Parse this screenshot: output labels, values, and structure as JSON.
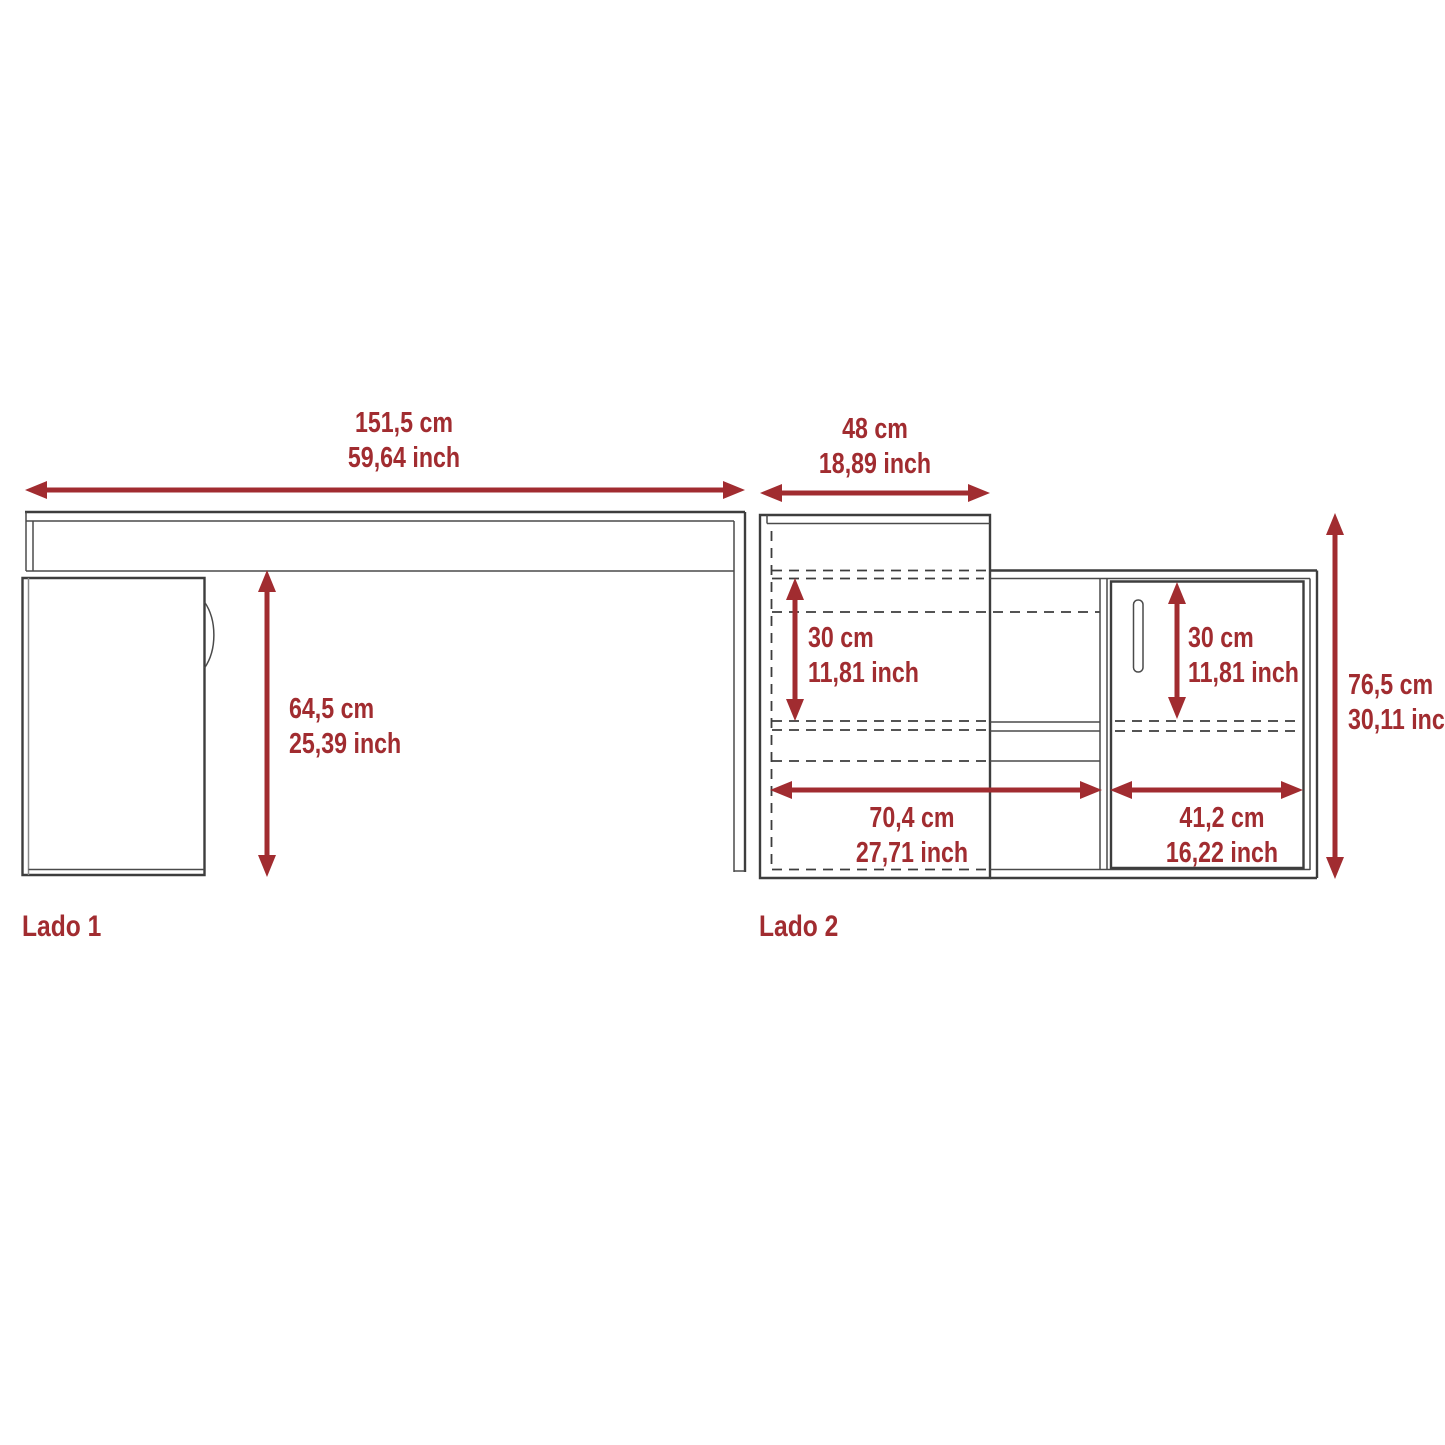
{
  "diagram": {
    "outline_color": "#3d3d3d",
    "dimension_color": "#a12c30",
    "side1": {
      "label": "Lado 1",
      "dims": {
        "width_cm": "151,5 cm",
        "width_inch": "59,64 inch",
        "clearance_cm": "64,5 cm",
        "clearance_inch": "25,39 inch"
      }
    },
    "side2": {
      "label": "Lado 2",
      "dims": {
        "hutch_width_cm": "48 cm",
        "hutch_width_inch": "18,89 inch",
        "hutch_shelf_cm": "30 cm",
        "hutch_shelf_inch": "11,81 inch",
        "door_opening_cm": "30 cm",
        "door_opening_inch": "11,81 inch",
        "total_height_cm": "76,5 cm",
        "total_height_inch": "30,11 inch",
        "left_section_cm": "70,4 cm",
        "left_section_inch": "27,71 inch",
        "door_width_cm": "41,2 cm",
        "door_width_inch": "16,22 inch"
      }
    }
  }
}
